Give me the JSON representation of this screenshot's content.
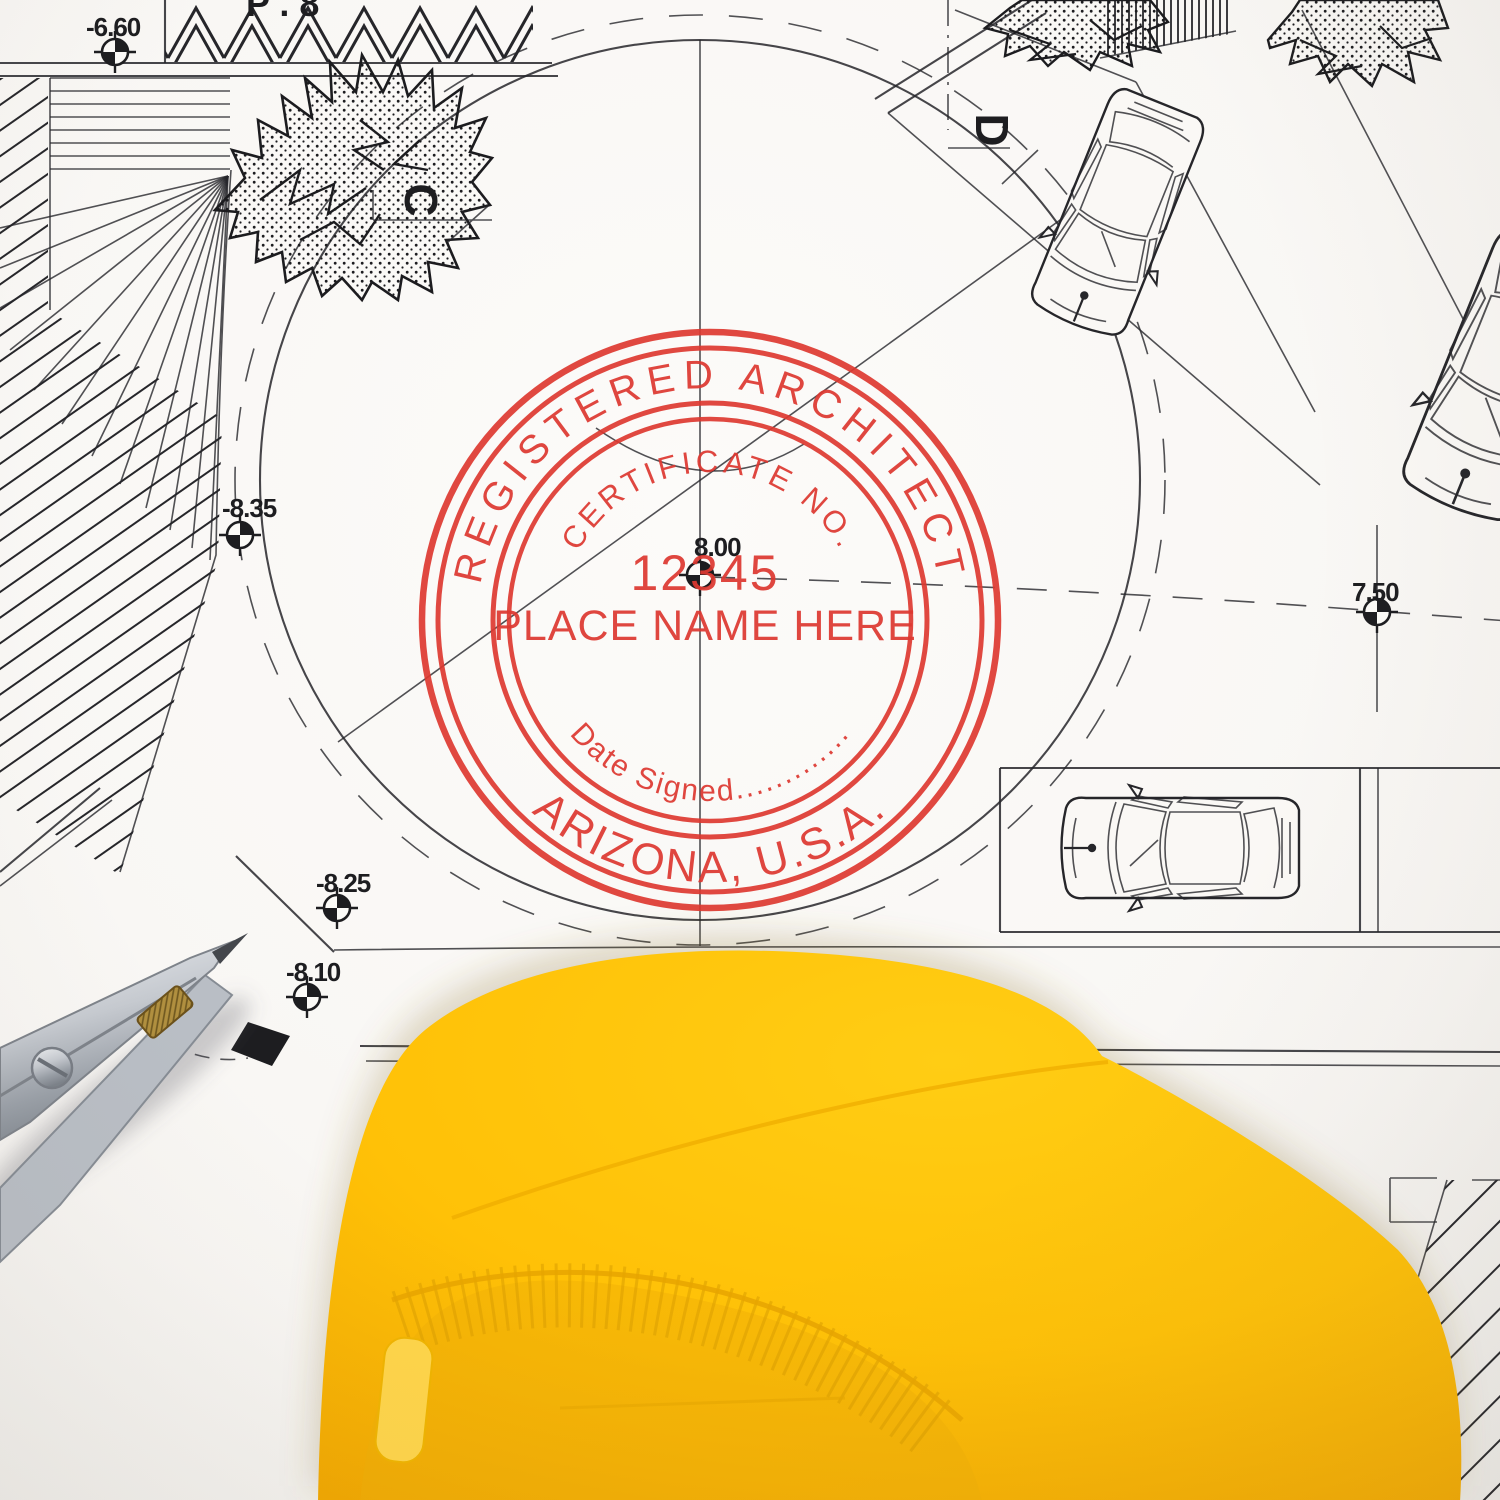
{
  "stamp": {
    "outer_top": "REGISTERED ARCHITECT",
    "inner_arc": "CERTIFICATE NO.",
    "certificate_number": "12345",
    "name_placeholder": "PLACE NAME HERE",
    "date_line": "Date Signed.............",
    "state_line": "ARIZONA, U.S.A.",
    "ink_color": "#DD3830"
  },
  "plan": {
    "edge_label": "P . 8",
    "elevation_markers": [
      {
        "label": "-6.60"
      },
      {
        "label": "-8.35"
      },
      {
        "label": "8.00"
      },
      {
        "label": "7.50"
      },
      {
        "label": "-8.25"
      },
      {
        "label": "-8.10"
      }
    ],
    "section_labels": [
      {
        "label": "C"
      },
      {
        "label": "D"
      }
    ]
  },
  "colors": {
    "stamp_red": "#DD3830",
    "hat_yellow": "#FFC60A",
    "hat_shadow_yellow": "#E9A400",
    "paper": "#FAF9F6",
    "line_black": "#26262a"
  }
}
